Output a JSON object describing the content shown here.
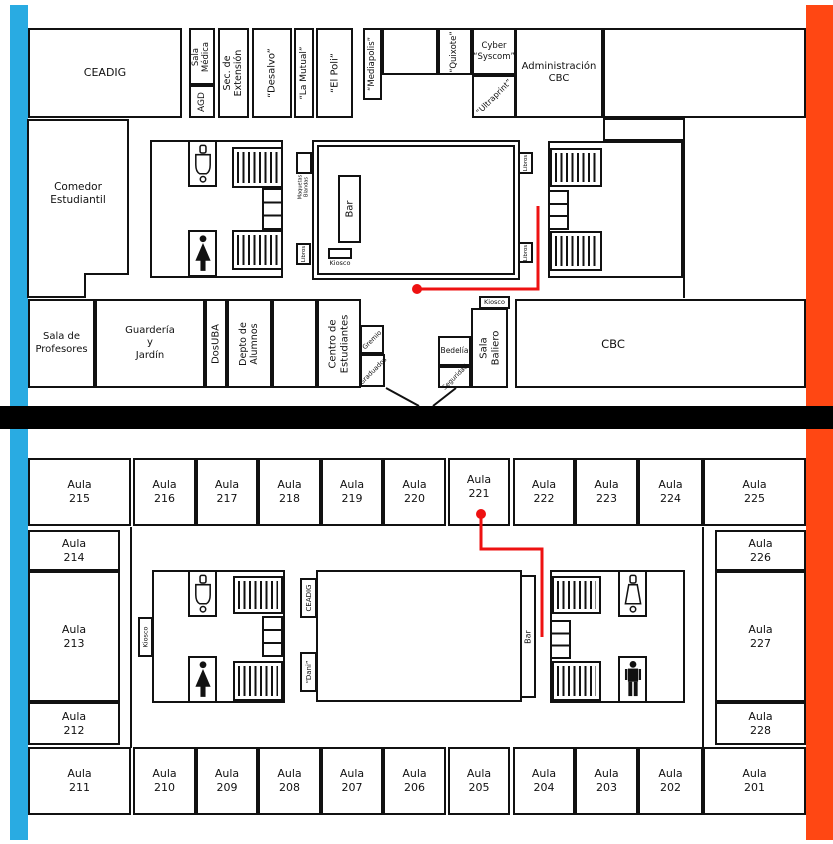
{
  "floor1": {
    "ceadig": "CEADIG",
    "sala_medica": "Sala\nMédica",
    "agd": "AGD",
    "sec_extension": "Sec. de\nExtensión",
    "desalvo": "“Desalvo”",
    "la_mutual": "“La Mutual”",
    "el_poli": "“El Poli”",
    "mediapolis": "“Mediapolis”",
    "quixote": "“Quixote”",
    "cyber_syscom": "Cyber\n“Syscom”",
    "ultraprint": "“Ultraprint”",
    "admin_cbc": "Administración\nCBC",
    "comedor": "Comedor\nEstudiantil",
    "bar": "Bar",
    "kiosco_bar": "Kiosco",
    "maquetas": "Maquetas\nBlandas",
    "libros": "Libros",
    "sala_profesores": "Sala de\nProfesores",
    "guarderia": "Guardería\ny\nJardín",
    "dosuba": "DosUBA",
    "depto_alumnos": "Depto de\nAlumnos",
    "centro_estudiantes": "Centro de\nEstudiantes",
    "gremio": "Gremio",
    "graduados": "Graduados",
    "bedelia": "Bedelía",
    "seguridad": "Seguridad",
    "sala_baliero": "Sala\nBaliero",
    "kiosco_baliero": "Kiosco",
    "cbc": "CBC"
  },
  "floor2": {
    "top_row": [
      "Aula\n215",
      "Aula\n216",
      "Aula\n217",
      "Aula\n218",
      "Aula\n219",
      "Aula\n220",
      "Aula\n221",
      "Aula\n222",
      "Aula\n223",
      "Aula\n224",
      "Aula\n225"
    ],
    "left_col": [
      "Aula\n214",
      "Aula\n213",
      "Aula\n212"
    ],
    "right_col": [
      "Aula\n226",
      "Aula\n227",
      "Aula\n228"
    ],
    "bottom_row": [
      "Aula\n211",
      "Aula\n210",
      "Aula\n209",
      "Aula\n208",
      "Aula\n207",
      "Aula\n206",
      "Aula\n205",
      "Aula\n204",
      "Aula\n203",
      "Aula\n202",
      "Aula\n201"
    ],
    "kiosco": "Kiosco",
    "ceadig": "CEADIG",
    "dani": "“Dani”",
    "bar": "Bar"
  },
  "route": {
    "floor1_points": "417,289 538,289 538,206",
    "floor2_points": "481,514 481,549 542,549 542,637"
  },
  "colors": {
    "edge_left": "#29abe2",
    "edge_right": "#ff4713",
    "route": "#ee1111",
    "wall": "#111111",
    "divider": "#000000"
  }
}
